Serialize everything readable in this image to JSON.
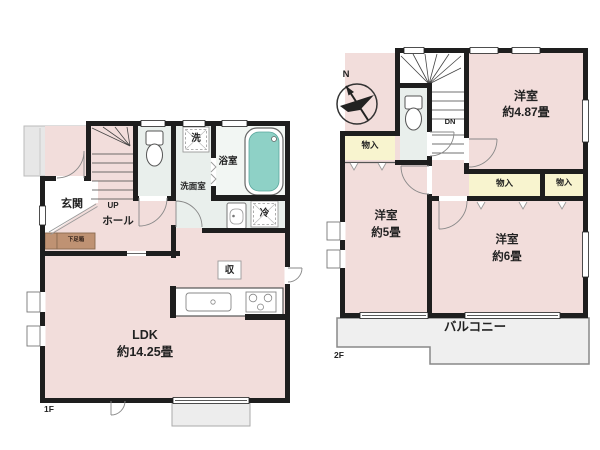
{
  "plans": {
    "floor1": {
      "label": "1F",
      "entrance": "玄関",
      "hall": "ホール",
      "up": "UP",
      "shoe_box": "下足箱",
      "washer": "洗",
      "bathroom": "浴室",
      "washroom": "洗面室",
      "fridge": "冷",
      "storage": "収",
      "ldk_name": "LDK",
      "ldk_size": "約14.25畳"
    },
    "floor2": {
      "label": "2F",
      "north": "N",
      "down": "DN",
      "closet": "物入",
      "bedroom_a_name": "洋室",
      "bedroom_a_size": "約4.87畳",
      "bedroom_b_name": "洋室",
      "bedroom_b_size": "約5畳",
      "bedroom_c_name": "洋室",
      "bedroom_c_size": "約6畳",
      "balcony": "バルコニー"
    },
    "colors": {
      "room_pink": "#f2dddb",
      "closet_yellow": "#f8f4cf",
      "wet_area_green": "#e9efec",
      "bathtub_teal": "#8ed1c6",
      "shoe_box_brown": "#bf9273",
      "wall_black": "#1e1e1e",
      "balcony_grey": "#efefef"
    }
  }
}
